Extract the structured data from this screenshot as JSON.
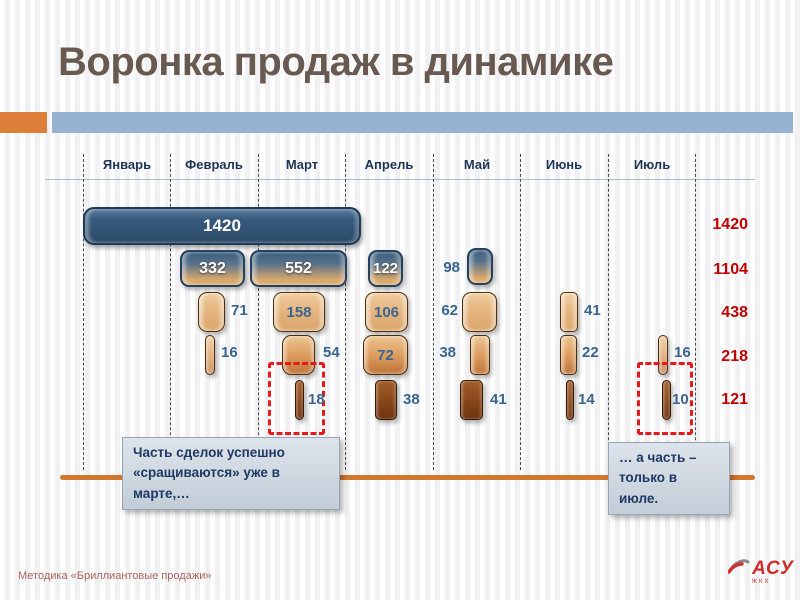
{
  "title": "Воронка продаж в динамике",
  "months": [
    "Январь",
    "Февраль",
    "Март",
    "Апрель",
    "Май",
    "Июнь",
    "Июль"
  ],
  "callouts": {
    "march": "Часть сделок успешно\n«сращиваются» уже в марте,…",
    "july": "… а часть –\nтолько в июле."
  },
  "footer": {
    "note": "Методика «Бриллиантовые продажи»",
    "logo_text": "АСУ",
    "logo_subtext": "ЖКХ"
  },
  "colors": {
    "stage1_bar": "#2c4b68",
    "stage2_bar_top": "#3d5e7e",
    "stage2_bar_bottom": "#dcab6c",
    "stage3_bar": "#e3b17b",
    "stage4_bar": "#c0753b",
    "stage5_bar": "#7c3d14",
    "totals_text": "#c00000",
    "highlight_dash": "#e51a1a",
    "timeline": "#d0772f",
    "accent_orange": "#dd7e3a",
    "accent_blue": "#96b3d2"
  },
  "chart_data": {
    "type": "bar",
    "subtype": "funnel-over-time",
    "title": "Воронка продаж в динамике",
    "categories": [
      "Январь",
      "Февраль",
      "Март",
      "Апрель",
      "Май",
      "Июнь",
      "Июль"
    ],
    "legend_position": "none",
    "grid": "dashed-vertical-column-dividers",
    "rows": [
      {
        "stage": 1,
        "total": 1420,
        "bars": [
          {
            "m": "Январь–Март",
            "v": 1420
          }
        ]
      },
      {
        "stage": 2,
        "total": 1104,
        "bars": [
          {
            "m": "Февраль",
            "v": 332
          },
          {
            "m": "Март",
            "v": 552
          },
          {
            "m": "Апрель",
            "v": 122
          },
          {
            "m": "Май",
            "v": 98
          }
        ]
      },
      {
        "stage": 3,
        "total": 438,
        "bars": [
          {
            "m": "Февраль",
            "v": 71
          },
          {
            "m": "Март",
            "v": 158
          },
          {
            "m": "Апрель",
            "v": 106
          },
          {
            "m": "Май",
            "v": 62
          },
          {
            "m": "Июнь",
            "v": 41
          }
        ]
      },
      {
        "stage": 4,
        "total": 218,
        "bars": [
          {
            "m": "Февраль",
            "v": 16
          },
          {
            "m": "Март",
            "v": 54
          },
          {
            "m": "Апрель",
            "v": 72
          },
          {
            "m": "Май",
            "v": 38
          },
          {
            "m": "Июнь",
            "v": 22
          },
          {
            "m": "Июль",
            "v": 16
          }
        ]
      },
      {
        "stage": 5,
        "total": 121,
        "bars": [
          {
            "m": "Март",
            "v": 18
          },
          {
            "m": "Апрель",
            "v": 38
          },
          {
            "m": "Май",
            "v": 41
          },
          {
            "m": "Июнь",
            "v": 14
          },
          {
            "m": "Июль",
            "v": 10
          }
        ]
      }
    ],
    "right_totals": [
      1420,
      1104,
      438,
      218,
      121
    ],
    "annotations": [
      "red dashed box around March stage-5 bar (18)",
      "red dashed box around July stage-4/5 bars (16, 10)"
    ]
  }
}
